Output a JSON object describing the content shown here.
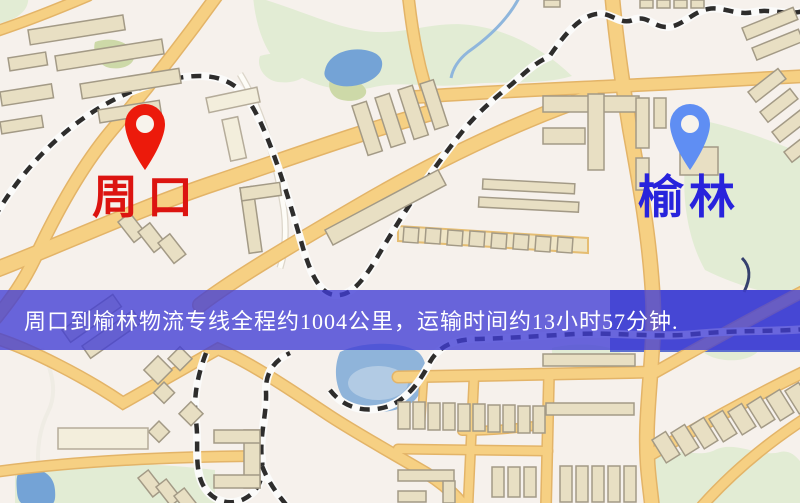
{
  "origin": {
    "name": "周口",
    "pin_color": "#ec1a0b",
    "label_color": "#dc1410"
  },
  "destination": {
    "name": "榆林",
    "pin_color": "#5f8ef3",
    "label_color": "#2823dc"
  },
  "banner": {
    "text": "周口到榆林物流专线全程约1004公里，运输时间约13小时57分钟.",
    "bg_color": "#403cd5",
    "bg_opacity": "0.78",
    "text_color": "#ffffff"
  },
  "route": {
    "distance_km": "1004",
    "duration": "13小时57分钟"
  },
  "map_palette": {
    "background": "#f6f1ec",
    "road_fill": "#f6d083",
    "road_casing": "#e3b468",
    "railway_dash": "#2e2d2c",
    "building_fill": "#e8dfc3",
    "park_green": "#e2ecd4",
    "water_blue": "#74a3d6"
  }
}
